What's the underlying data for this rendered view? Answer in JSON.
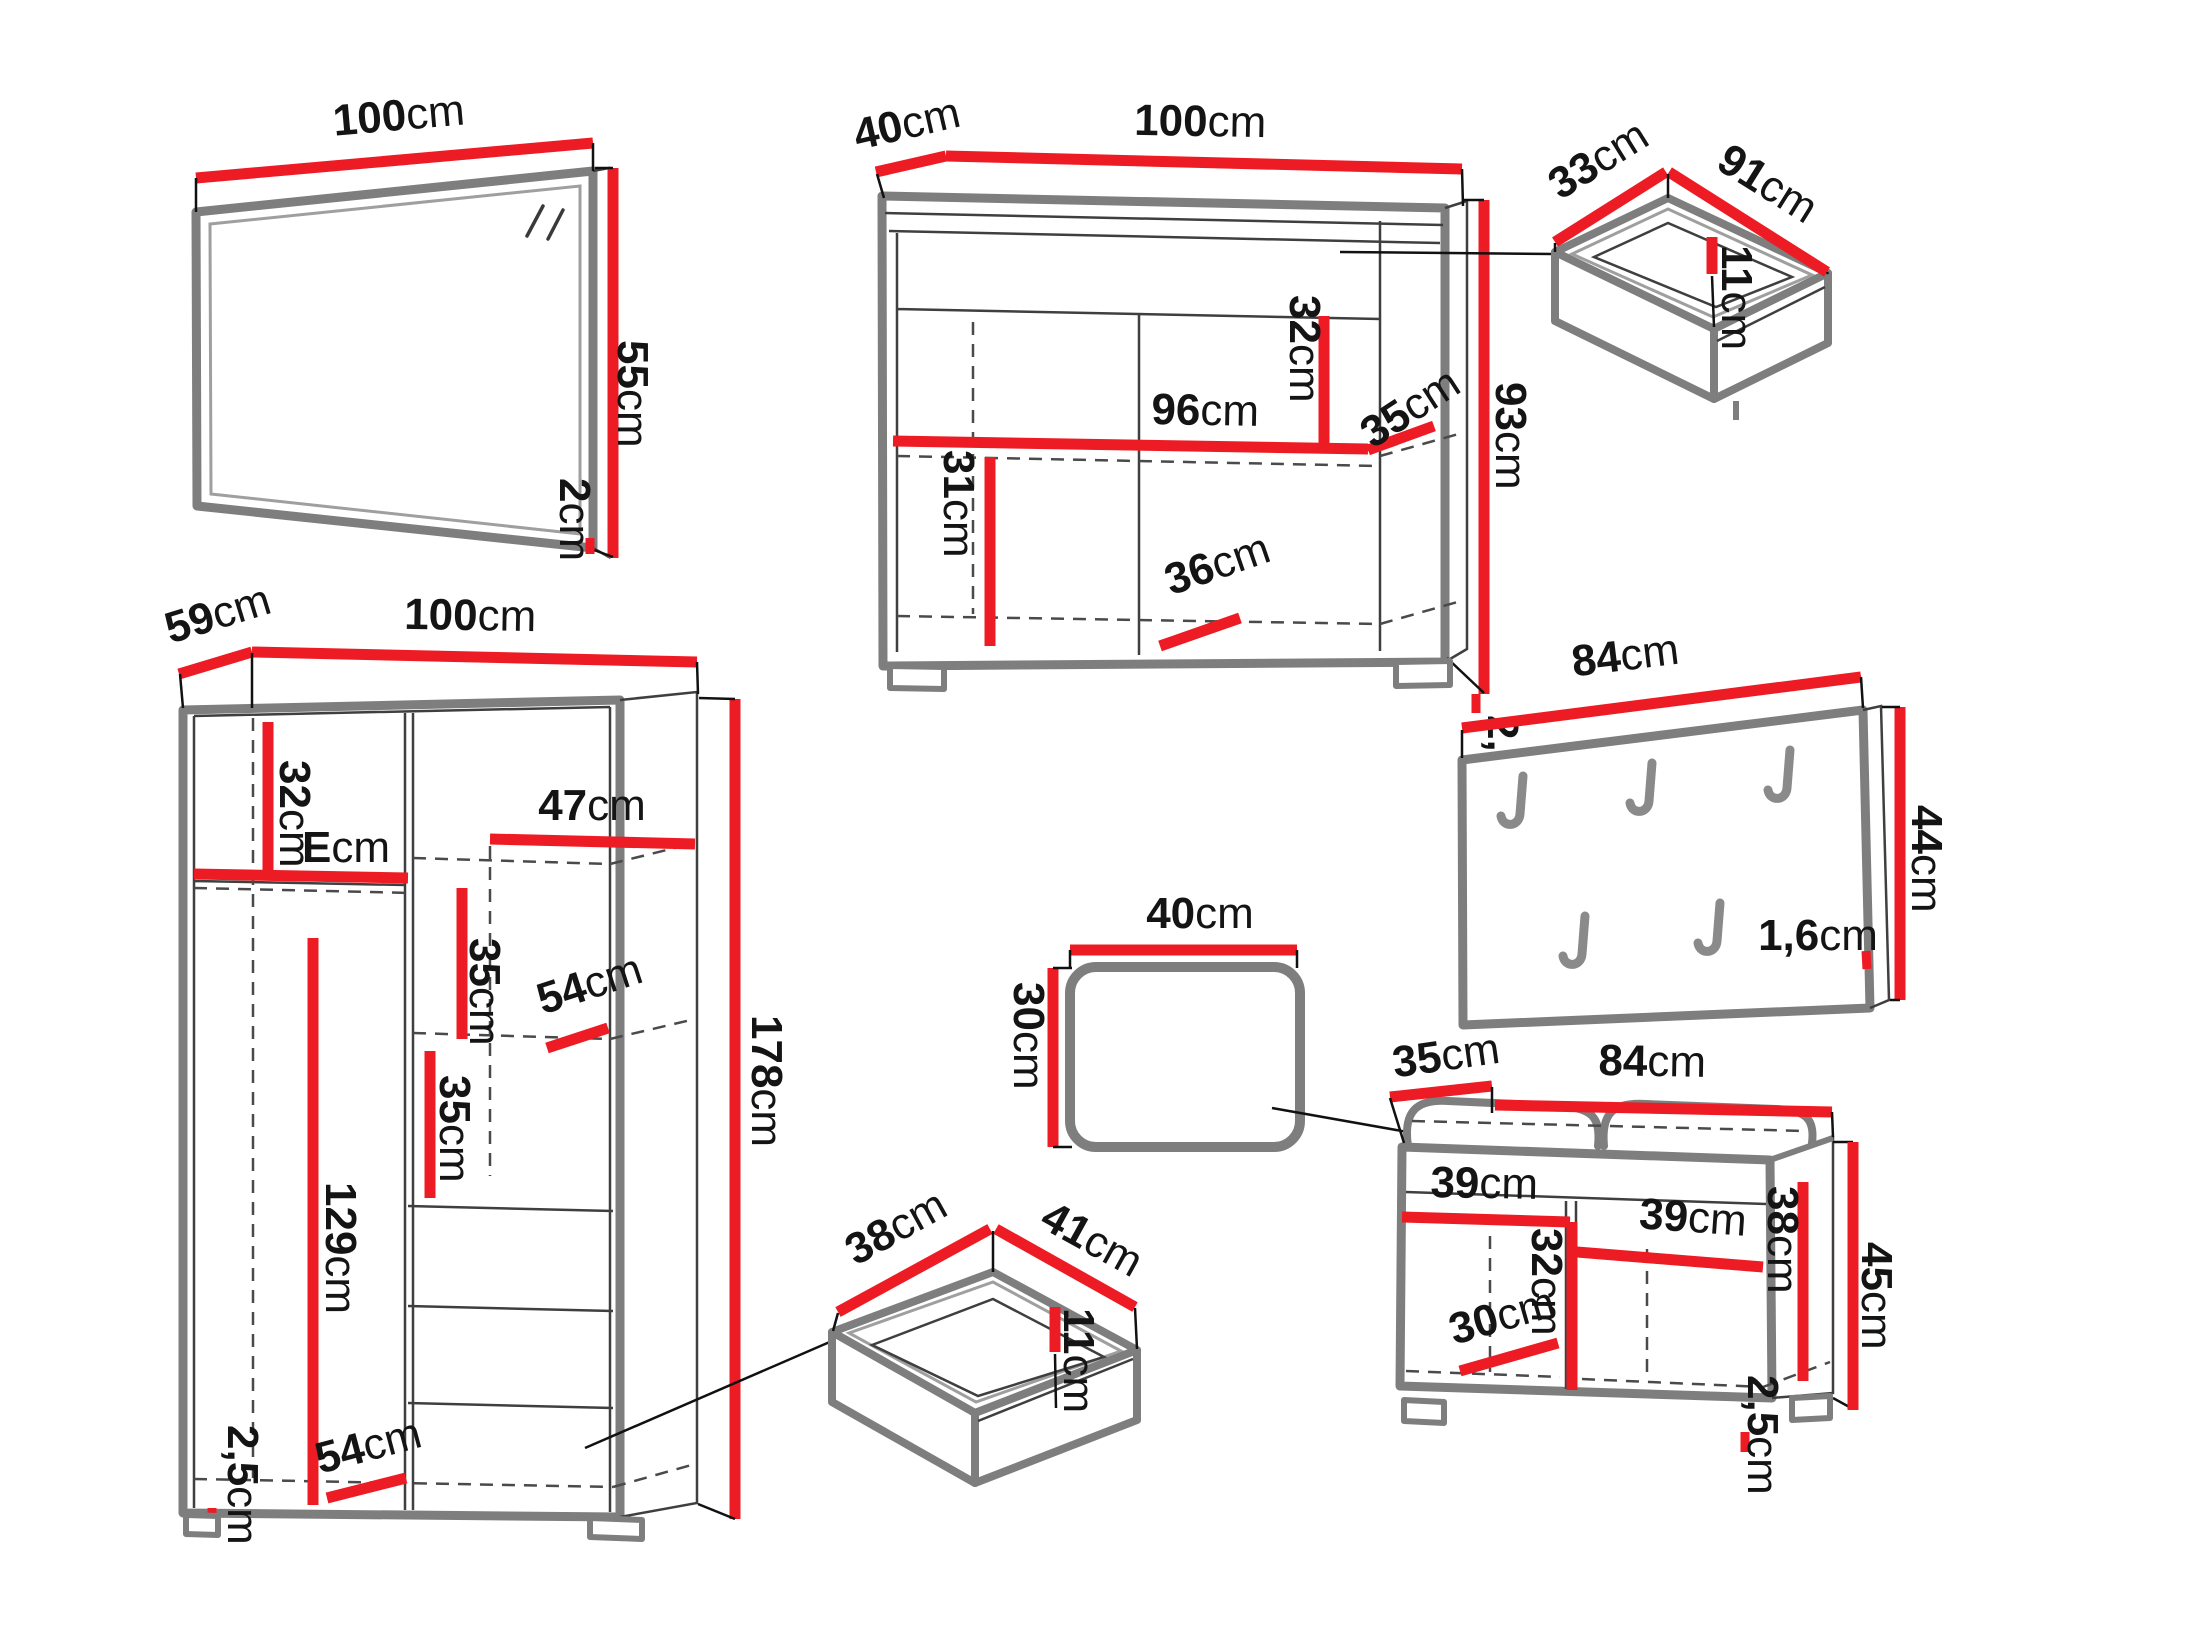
{
  "diagram": {
    "type": "furniture-dimension-diagram",
    "unit": "cm",
    "colors": {
      "dimension_line": "#ed1c24",
      "furniture_outline": "#7e7e7e",
      "label_text": "#141414"
    }
  },
  "pieces": {
    "mirror": {
      "width": {
        "v": "100",
        "u": "cm"
      },
      "height": {
        "v": "55",
        "u": "cm"
      },
      "thickness": {
        "v": "2",
        "u": "cm"
      }
    },
    "sideboard": {
      "depth": {
        "v": "40",
        "u": "cm"
      },
      "width": {
        "v": "100",
        "u": "cm"
      },
      "height": {
        "v": "93",
        "u": "cm"
      },
      "inner_width": {
        "v": "96",
        "u": "cm"
      },
      "upper_inner_height": {
        "v": "32",
        "u": "cm"
      },
      "lower_inner_height": {
        "v": "31",
        "u": "cm"
      },
      "inner_depth": {
        "v": "35",
        "u": "cm"
      },
      "base_width": {
        "v": "36",
        "u": "cm"
      },
      "plinth_height": {
        "v": "2,5",
        "u": "cm"
      }
    },
    "drawer_large": {
      "depth": {
        "v": "33",
        "u": "cm"
      },
      "width": {
        "v": "91",
        "u": "cm"
      },
      "height": {
        "v": "11",
        "u": "cm"
      }
    },
    "wardrobe": {
      "depth": {
        "v": "59",
        "u": "cm"
      },
      "width": {
        "v": "100",
        "u": "cm"
      },
      "height": {
        "v": "178",
        "u": "cm"
      },
      "top_shelf_height": {
        "v": "32",
        "u": "cm"
      },
      "left_section_width": {
        "v": "E",
        "u": "cm"
      },
      "right_shelf_width": {
        "v": "47",
        "u": "cm"
      },
      "upper_shelf_gap": {
        "v": "35",
        "u": "cm"
      },
      "shelf_depth": {
        "v": "54",
        "u": "cm"
      },
      "lower_shelf_gap": {
        "v": "35",
        "u": "cm"
      },
      "hanging_height": {
        "v": "129",
        "u": "cm"
      },
      "base_depth": {
        "v": "54",
        "u": "cm"
      },
      "plinth_height": {
        "v": "2,5",
        "u": "cm"
      }
    },
    "coat_rack": {
      "width": {
        "v": "84",
        "u": "cm"
      },
      "height": {
        "v": "44",
        "u": "cm"
      },
      "thickness": {
        "v": "1,6",
        "u": "cm"
      }
    },
    "stool": {
      "width": {
        "v": "40",
        "u": "cm"
      },
      "height": {
        "v": "30",
        "u": "cm"
      }
    },
    "drawer_small": {
      "depth": {
        "v": "38",
        "u": "cm"
      },
      "width": {
        "v": "41",
        "u": "cm"
      },
      "height": {
        "v": "11",
        "u": "cm"
      }
    },
    "bench": {
      "depth": {
        "v": "35",
        "u": "cm"
      },
      "width": {
        "v": "84",
        "u": "cm"
      },
      "left_compartment_width": {
        "v": "39",
        "u": "cm"
      },
      "right_compartment_width": {
        "v": "39",
        "u": "cm"
      },
      "divider_height": {
        "v": "32",
        "u": "cm"
      },
      "inner_height": {
        "v": "38",
        "u": "cm"
      },
      "base_depth": {
        "v": "30",
        "u": "cm"
      },
      "height": {
        "v": "45",
        "u": "cm"
      },
      "plinth_height": {
        "v": "2,5",
        "u": "cm"
      }
    }
  }
}
